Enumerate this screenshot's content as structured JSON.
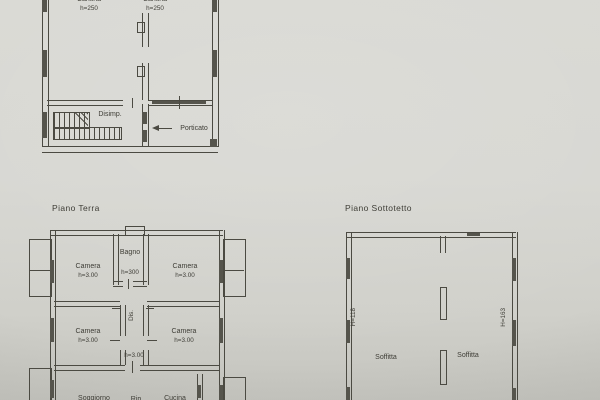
{
  "colors": {
    "paper": "#d6d6d1",
    "line": "#4b4a42",
    "dark": "#55544c",
    "text": "#3e3d36"
  },
  "basement": {
    "room_left": {
      "name": "Cantina",
      "h": "h=250"
    },
    "room_right": {
      "name": "Cantina",
      "h": "h=250"
    },
    "disimp": "Disimp.",
    "porticato": "Porticato"
  },
  "terra": {
    "title": "Piano Terra",
    "bagno": {
      "name": "Bagno",
      "h": "h=300"
    },
    "camera_tl": {
      "name": "Camera",
      "h": "h=3.00"
    },
    "camera_tr": {
      "name": "Camera",
      "h": "h=3.00"
    },
    "camera_ml": {
      "name": "Camera",
      "h": "h=3.00"
    },
    "camera_mr": {
      "name": "Camera",
      "h": "h=3.00"
    },
    "dis": "Dis.",
    "corridor_h": "h=3.00",
    "soggiorno": "Soggiorno",
    "rip": "Rip.",
    "cucina": "Cucina"
  },
  "sottotetto": {
    "title": "Piano Sottotetto",
    "h_left": "H=118",
    "h_right": "H=163",
    "soffitta_left": "Soffitta",
    "soffitta_right": "Soffitta"
  }
}
